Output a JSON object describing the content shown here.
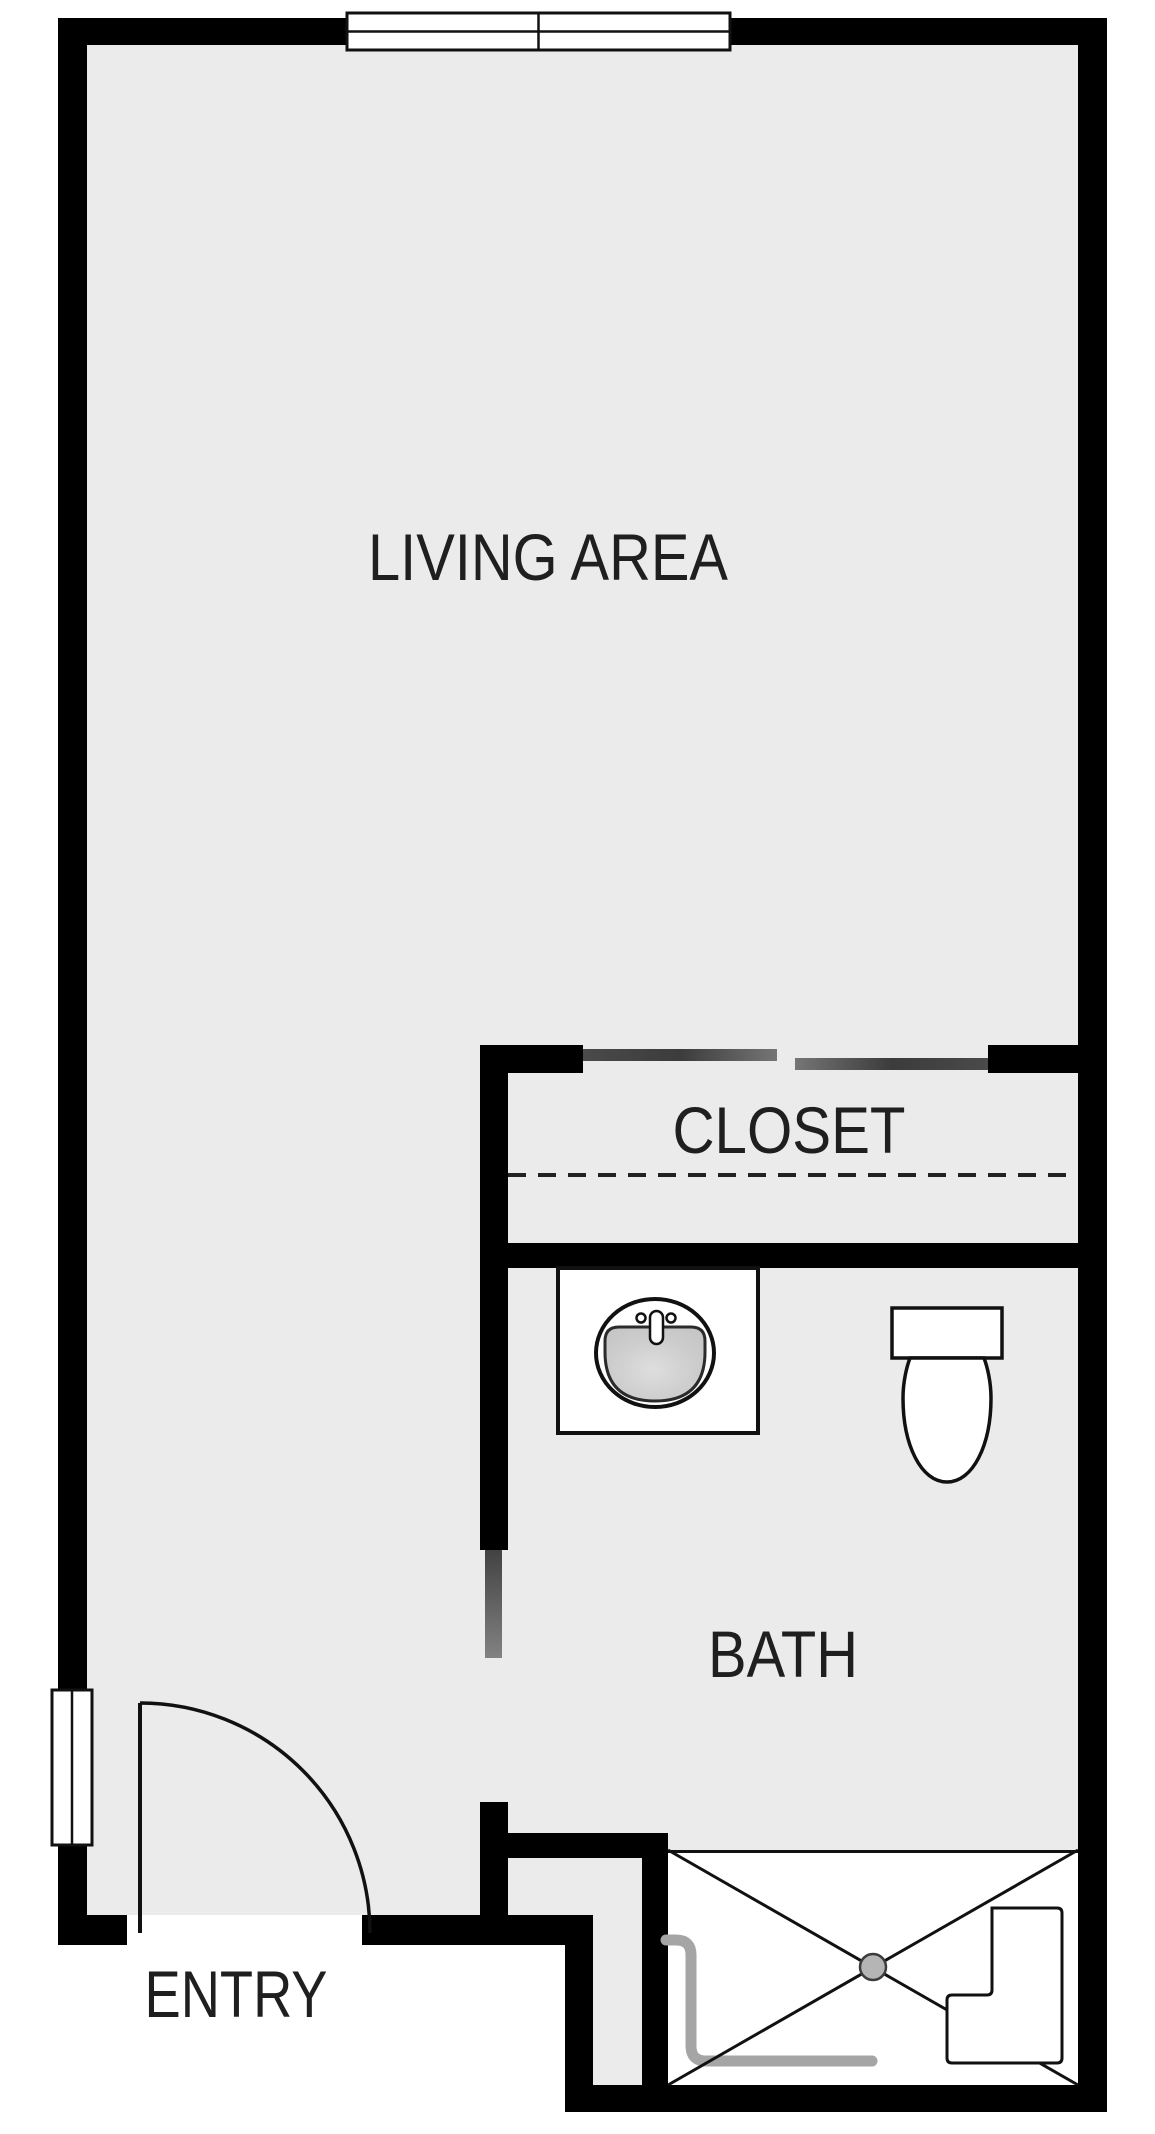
{
  "colors": {
    "floor": "#ebebeb",
    "wall": "#000000",
    "outside": "#ffffff",
    "text": "#1f1f1f",
    "fixture_stroke": "#111111",
    "sliding_door_dark": "#3f3f3f",
    "sliding_door_light": "#777777",
    "opening_marker_top": "#424242",
    "opening_marker_bottom": "#828282",
    "curtain": "#a5a5a5",
    "drain_fill": "#b5b5b5",
    "drain_stroke": "#3c3c3c",
    "sink_bowl": "#c9c9c9",
    "sink_bowl_highlight": "#dedede"
  },
  "rooms": {
    "living": {
      "label": "LIVING AREA"
    },
    "closet": {
      "label": "CLOSET"
    },
    "bath": {
      "label": "BATH"
    },
    "entry": {
      "label": "ENTRY"
    }
  },
  "fixtures": {
    "top_window": "window-4-pane",
    "left_window": "window-2-pane",
    "entry_door": "hinged-door-90deg-swing",
    "closet_doors": "bypass-sliding-doors",
    "closet_rod": "dashed-shelf-rod-line",
    "sink": "oval-basin-with-faucet",
    "toilet": "tank-and-bowl",
    "shower": "pan-with-x-drain-bench-and-curtain"
  }
}
